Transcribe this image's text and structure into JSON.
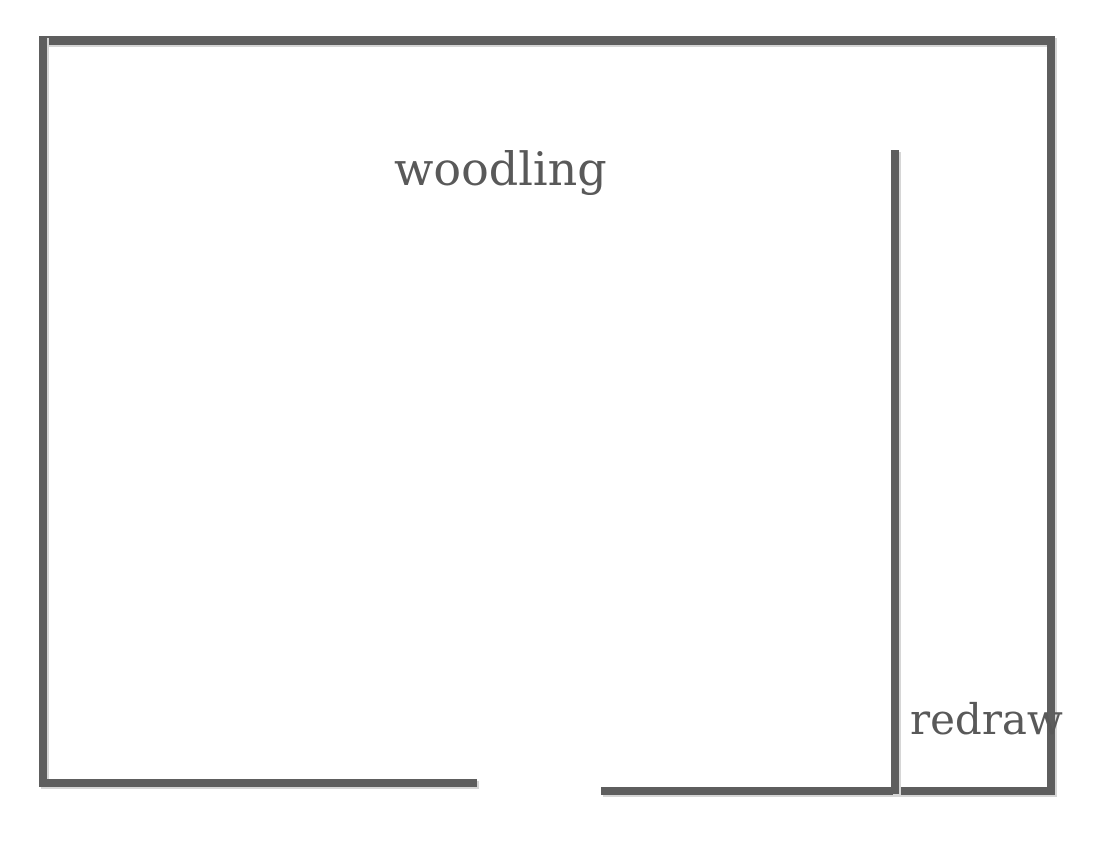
{
  "drawing": {
    "background_color": "#ffffff",
    "wall_color": "#5e5e5e",
    "text_color": "#595959",
    "labels": {
      "woodling": "woodling",
      "redraw": "redraw"
    }
  }
}
